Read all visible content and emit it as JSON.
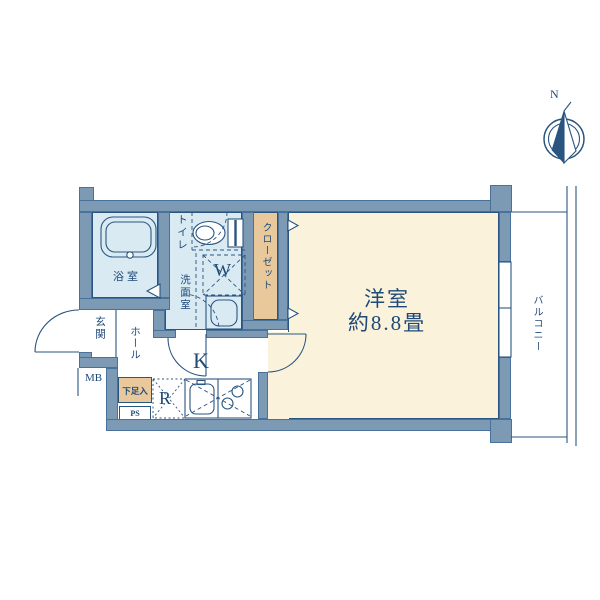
{
  "labels": {
    "main_room": "洋室",
    "main_room_size": "約8.8畳",
    "balcony": "バルコニー",
    "closet": "クローゼット",
    "toilet": "トイレ",
    "washroom": "洗面室",
    "bathroom": "浴室",
    "entrance": "玄関",
    "hall": "ホール",
    "kitchen": "K",
    "refrigerator_space": "R",
    "washer_space": "W",
    "meter_box": "MB",
    "shoe_cabinet": "下足入",
    "pipe_shaft": "PS",
    "compass_north": "N"
  },
  "colors": {
    "wall": "#7d9ab4",
    "wall_edge": "#48719c",
    "water_room_fill": "#d9eaf3",
    "main_room_fill": "#faf2da",
    "closet_fill": "#e9c89c",
    "line": "#2a5580",
    "text": "#1f4a78"
  }
}
